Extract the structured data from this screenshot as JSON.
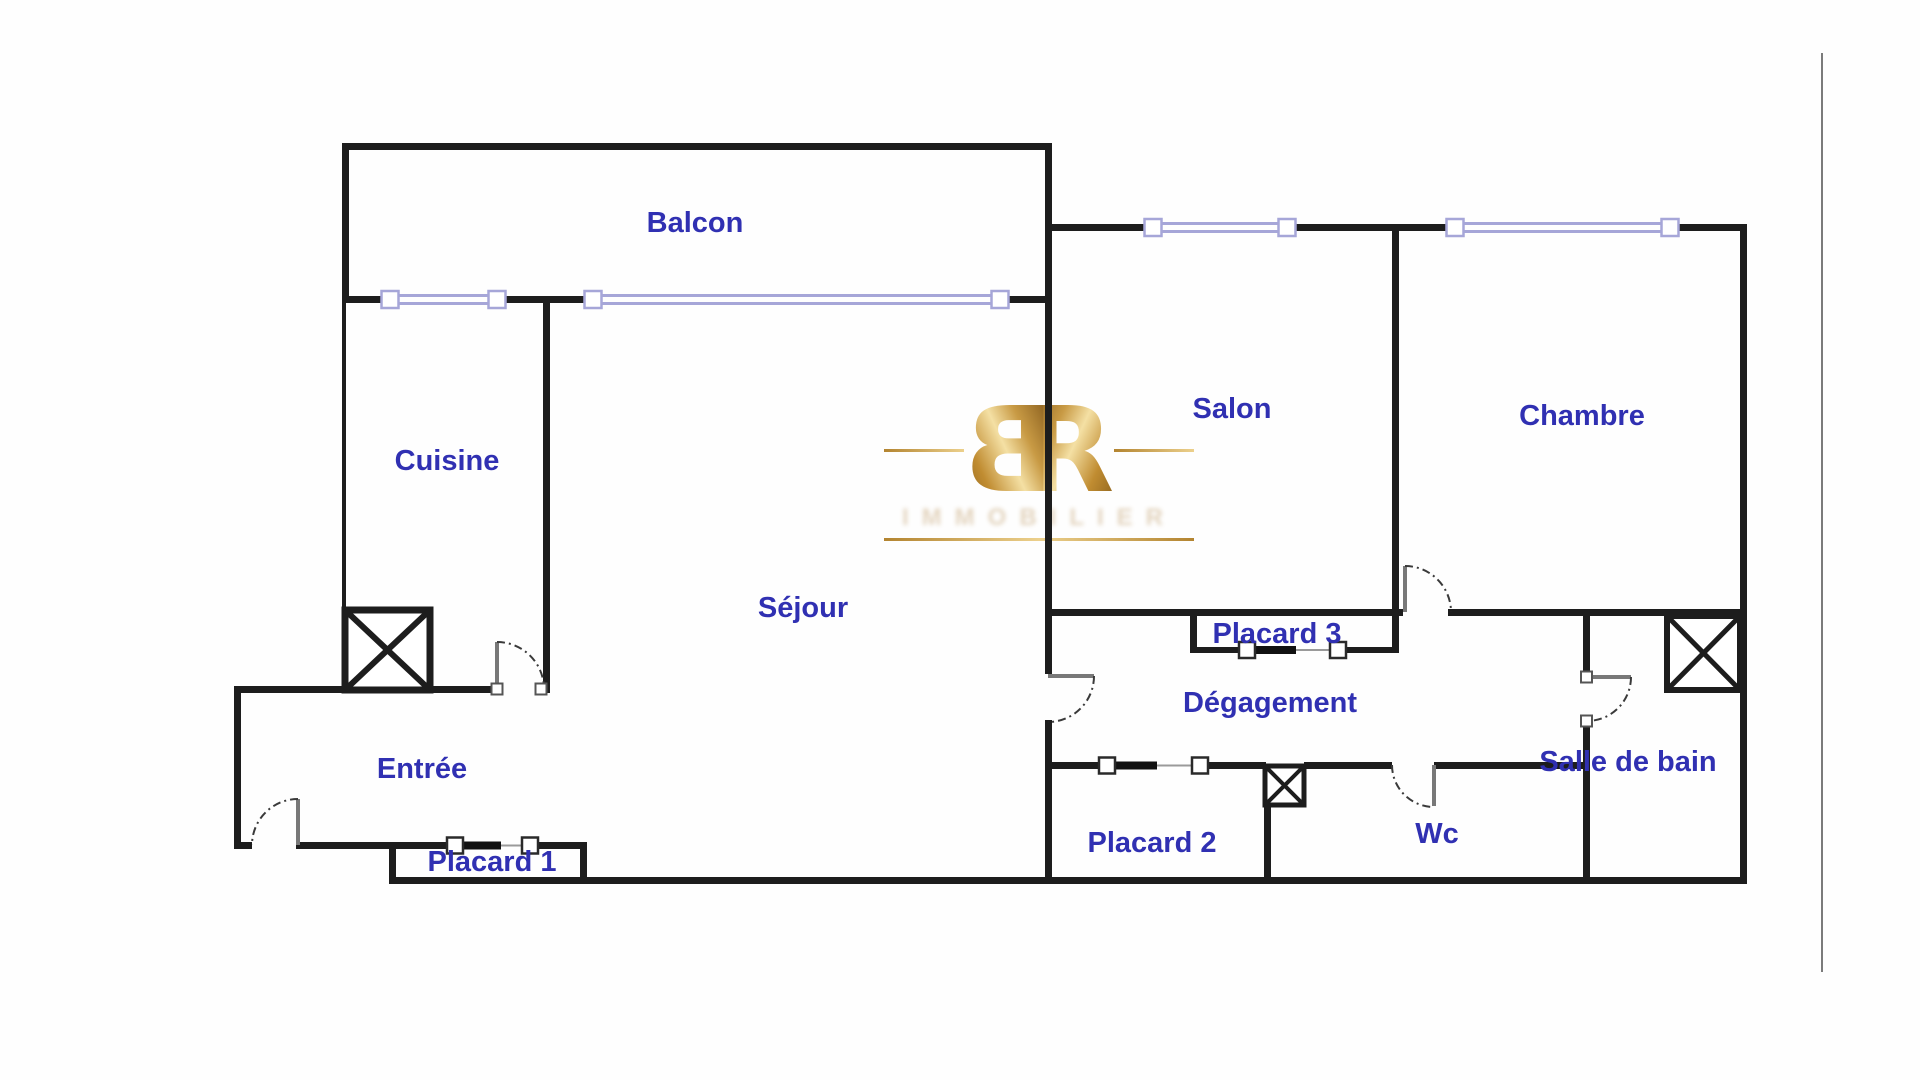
{
  "labels": {
    "balcon": "Balcon",
    "cuisine": "Cuisine",
    "sejour": "Séjour",
    "salon": "Salon",
    "chambre": "Chambre",
    "entree": "Entrée",
    "placard1": "Placard 1",
    "placard2": "Placard 2",
    "placard3": "Placard 3",
    "degagement": "Dégagement",
    "wc": "Wc",
    "salle_de_bain": "Salle de bain"
  },
  "watermark": {
    "letter_b": "B",
    "letter_r": "R",
    "subtext": "IMMOBILIER"
  },
  "colors": {
    "wall": "#1d1d1d",
    "room_label": "#3030b2",
    "window_symbol": "#a6a6d8",
    "watermark_gold": "#c89a44",
    "page_edge_line": "#7b7b7b"
  }
}
